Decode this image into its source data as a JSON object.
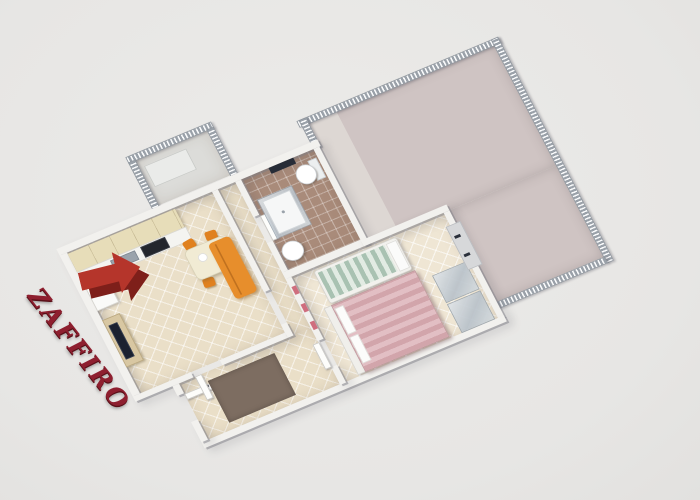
{
  "watermark": {
    "text": "ZAFFIRO",
    "color": "#8e1f2f"
  },
  "arrow": {
    "meaning": "entrance-direction",
    "points": "up-right",
    "fill": "#b5352b",
    "side": "#7e1f1a"
  },
  "palette": {
    "background": "#e9e8e6",
    "walls": "#f2f1ee",
    "living_floor": "#eadfc8",
    "bedroom_floor": "#efe6d4",
    "bathroom_floor": "#a98b7a",
    "terrace_floor": "#cfc4c3",
    "balcony_floor": "#dcdcd9",
    "furniture_orange": "#e0811f",
    "sofa_orange": "#e78e2c",
    "double_bed_pink": "#d2a5ab",
    "single_bed_green": "#a9c2b2",
    "wood": "#d8c7a2",
    "appliance_dark": "#23262d",
    "rug_brown": "#7d6d61"
  },
  "inventory": {
    "rooms": [
      "living-room-with-kitchen",
      "hallway",
      "bathroom",
      "bedroom",
      "entry-room",
      "kitchen-balcony",
      "wraparound-terrace"
    ],
    "furniture": [
      "kitchen-cabinets",
      "kitchen-counter",
      "kitchen-sink",
      "stove",
      "tall-cabinet",
      "dining-table",
      "dining-chairs-x4",
      "tv-stand",
      "tv",
      "orange-sofa",
      "shower-cabin",
      "washbasin",
      "toilet",
      "single-bed-green",
      "double-bed-pink",
      "wardrobes",
      "rug",
      "doors",
      "railings"
    ]
  }
}
